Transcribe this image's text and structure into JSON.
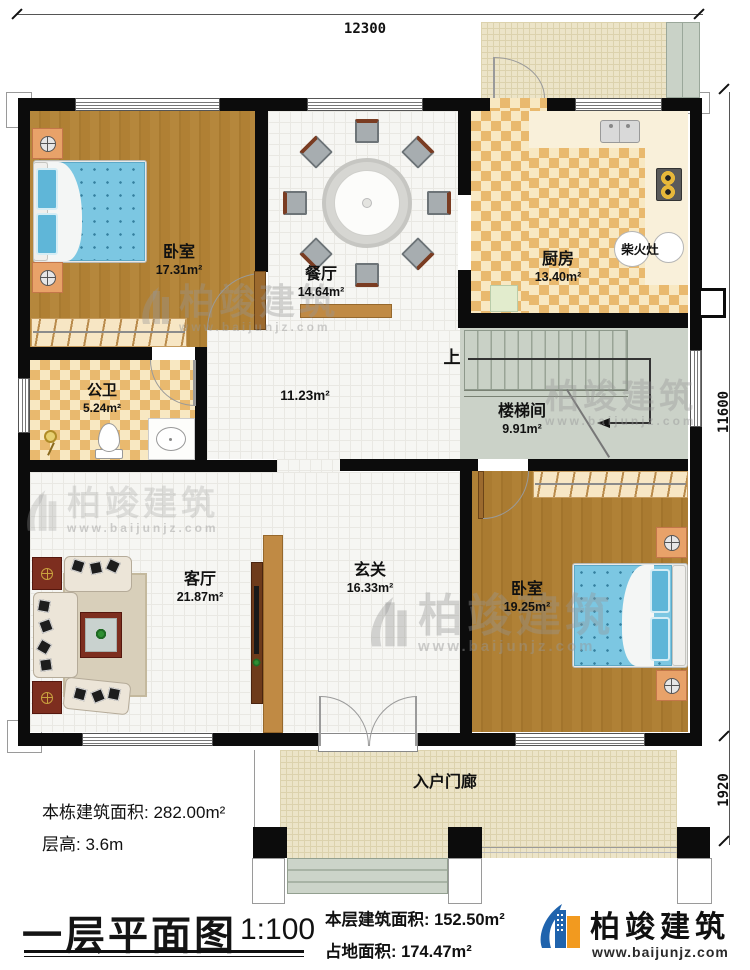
{
  "plan": {
    "sheet_title": "一层平面图",
    "scale": "1:100",
    "dims": {
      "top": "12300",
      "right": "11600",
      "porch": "1920"
    },
    "rooms": {
      "bedroom1": {
        "name": "卧室",
        "area": "17.31m²"
      },
      "dining": {
        "name": "餐厅",
        "area": "14.64m²"
      },
      "kitchen": {
        "name": "厨房",
        "area": "13.40m²"
      },
      "stove": {
        "name": "柴火灶"
      },
      "bathroom": {
        "name": "公卫",
        "area": "5.24m²"
      },
      "corridor": {
        "area": "11.23m²"
      },
      "stair": {
        "name": "楼梯间",
        "area": "9.91m²",
        "up": "上"
      },
      "living": {
        "name": "客厅",
        "area": "21.87m²"
      },
      "hall": {
        "name": "玄关",
        "area": "16.33m²"
      },
      "bedroom2": {
        "name": "卧室",
        "area": "19.25m²"
      },
      "porch": {
        "name": "入户门廊"
      }
    },
    "notes": {
      "building_total": "本栋建筑面积: 282.00m²",
      "floor_height": "层高: 3.6m",
      "floor_area": "本层建筑面积: 152.50m²",
      "footprint": "占地面积: 174.47m²"
    },
    "brand": {
      "name": "柏竣建筑",
      "site": "www.baijunjz.com"
    }
  }
}
